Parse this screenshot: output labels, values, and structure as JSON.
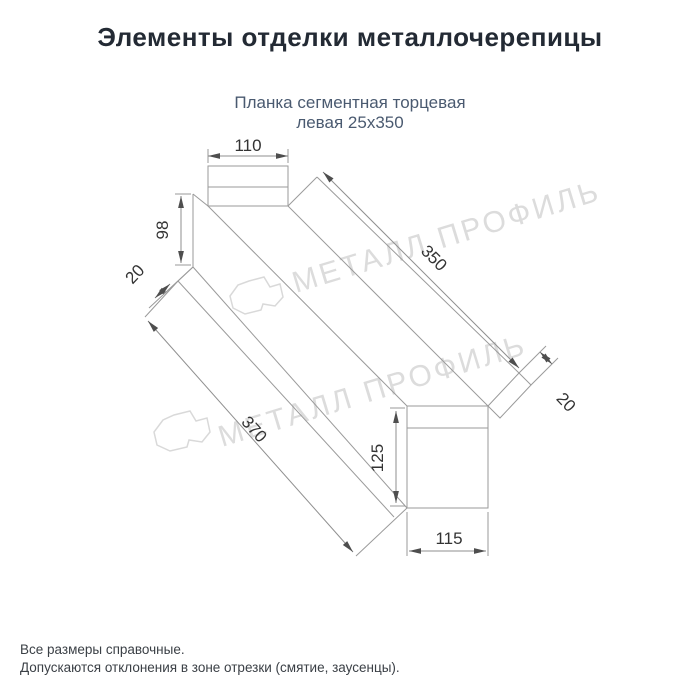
{
  "header": {
    "title": "Элементы отделки металлочерепицы"
  },
  "product": {
    "subtitle_line1": "Планка сегментная торцевая",
    "subtitle_line2": "левая 25х350"
  },
  "dimensions": {
    "top_width": "110",
    "left_height": "98",
    "left_flange": "20",
    "length_top": "350",
    "length_bottom": "370",
    "right_flange": "20",
    "bottom_height": "125",
    "bottom_width": "115"
  },
  "watermark": {
    "text": "МЕТАЛЛ ПРОФИЛЬ"
  },
  "footer": {
    "line1": "Все размеры справочные.",
    "line2": "Допускаются отклонения в зоне отрезки (смятие, заусенцы)."
  },
  "colors": {
    "background": "#ffffff",
    "line": "#9a9a9a",
    "dimension_text": "#333333",
    "title_text": "#232a34",
    "subtitle_text": "#4a5a70",
    "watermark": "#dcdcdc",
    "footer_text": "#3b4046"
  }
}
